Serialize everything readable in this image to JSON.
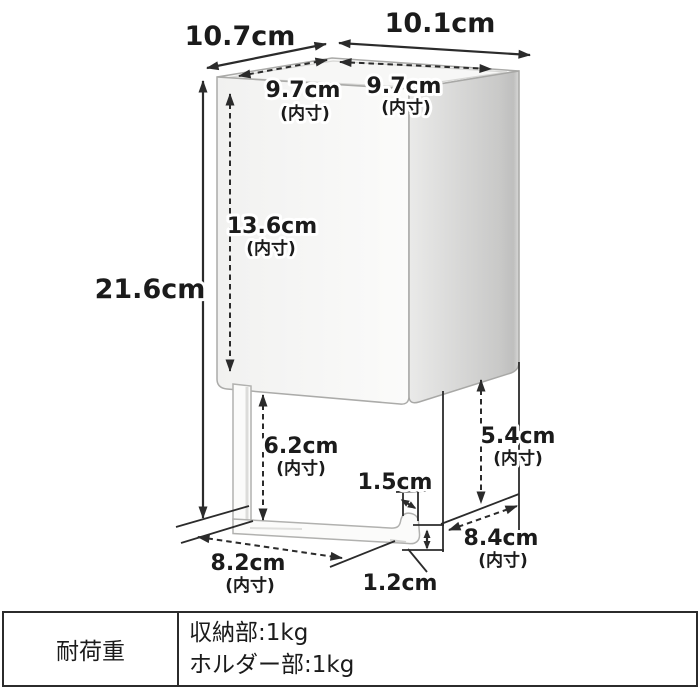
{
  "diagram": {
    "dimensions": {
      "outer": {
        "top_left_edge": "10.7cm",
        "top_right_edge": "10.1cm",
        "height": "21.6cm"
      },
      "inner": {
        "top_left": {
          "value": "9.7cm",
          "note": "(内寸)"
        },
        "top_right": {
          "value": "9.7cm",
          "note": "(内寸)"
        },
        "box_inner_height": {
          "value": "13.6cm",
          "note": "(内寸)"
        },
        "holder_gap_left": {
          "value": "6.2cm",
          "note": "(内寸)"
        },
        "holder_gap_right": {
          "value": "5.4cm",
          "note": "(内寸)"
        },
        "holder_bar_length": {
          "value": "8.2cm",
          "note": "(内寸)"
        },
        "holder_depth": {
          "value": "8.4cm",
          "note": "(内寸)"
        }
      },
      "details": {
        "hook_gap": "1.5cm",
        "bar_thickness": "1.2cm"
      }
    }
  },
  "spec_table": {
    "label": "耐荷重",
    "values": [
      "収納部:1kg",
      "ホルダー部:1kg"
    ]
  },
  "colors": {
    "line": "#2b2b2b",
    "box_edge": "#a9a9a7",
    "box_face_light": "#f3f3f2",
    "box_face_shaded": "#c3c3c2",
    "background": "#ffffff"
  }
}
